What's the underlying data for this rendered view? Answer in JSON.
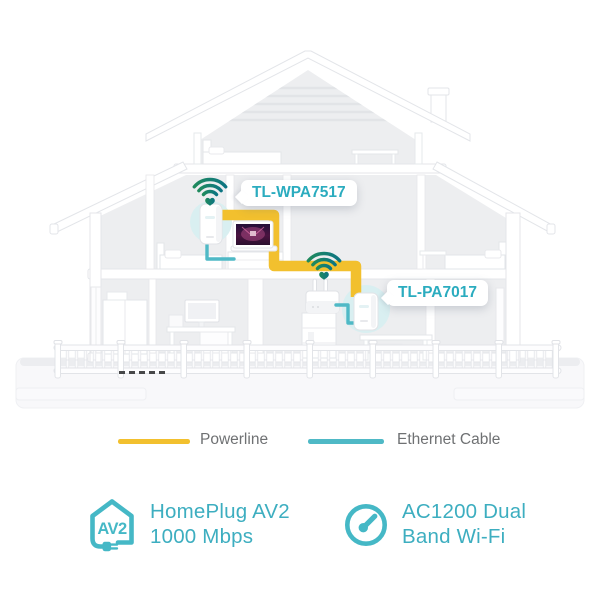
{
  "illustration": {
    "name": "powerline-kit-home-network-diagram",
    "devices": [
      {
        "label": "TL-WPA7517"
      },
      {
        "label": "TL-PA7017"
      }
    ]
  },
  "legend": {
    "items": [
      {
        "label": "Powerline",
        "color": "#F2C02E"
      },
      {
        "label": "Ethernet Cable",
        "color": "#4FB9C6"
      }
    ]
  },
  "features": [
    {
      "badge": "AV2",
      "line1": "HomePlug AV2",
      "line2": "1000 Mbps"
    },
    {
      "line1": "AC1200 Dual",
      "line2": "Band Wi-Fi"
    }
  ],
  "colors": {
    "powerline_yellow": "#F2C02E",
    "ethernet_teal": "#4FB9C6",
    "device_label_teal": "#2BACBF",
    "feature_teal": "#45B8C6",
    "feature_text_teal": "#3DAEC0",
    "wifi_gradient_green": "#1F8A5D",
    "wifi_gradient_teal": "#0D7583",
    "device_halo_teal": "#D9EFF1",
    "legend_text_gray": "#6F7173"
  }
}
